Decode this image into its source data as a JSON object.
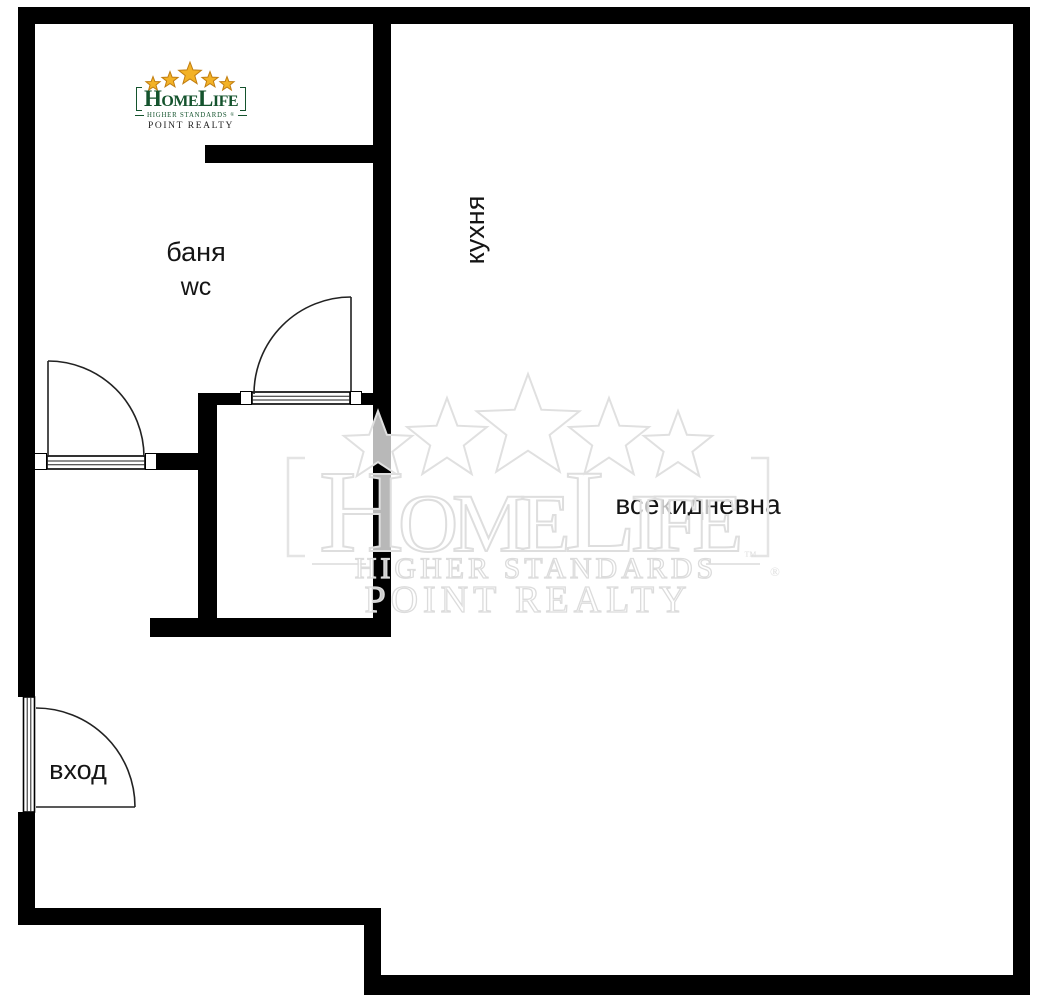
{
  "canvas": {
    "background": "#ffffff",
    "wall_color": "#000000",
    "door_line_color": "#222222"
  },
  "rooms": {
    "bathroom_label": "баня",
    "bathroom_sublabel": "wc",
    "kitchen_label": "кухня",
    "living_room_label": "всекидневна",
    "entrance_label": "вход"
  },
  "logo": {
    "brand": "HomeLife",
    "tagline": "HIGHER STANDARDS",
    "registered_mark": "®",
    "subbrand": "POINT REALTY",
    "star_color": "#f3b226",
    "star_edge_color": "#c07d10",
    "brand_color": "#14532d",
    "subbrand_color": "#1f1f1f"
  },
  "watermark": {
    "brand": "HomeLife",
    "tagline": "HIGHER STANDARDS",
    "trademark_mark": "™",
    "registered_mark": "®",
    "subbrand": "POINT REALTY"
  }
}
